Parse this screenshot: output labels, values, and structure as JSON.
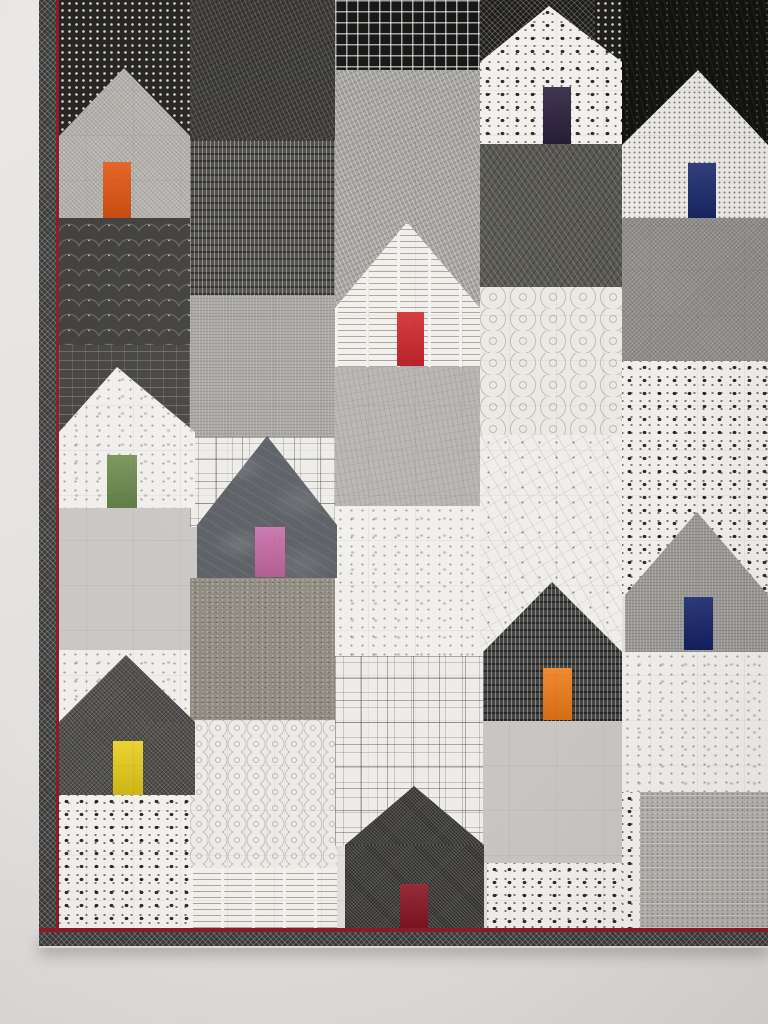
{
  "scene": {
    "description": "Wall-hung modern patchwork quilt of black, white and gray printed-fabric houses, each with a single brightly colored door; dark binding with thin red piping, photographed against a pale gray wall",
    "wall_color": "#e5e3e1",
    "house_count": 10,
    "door_colors": [
      "orange",
      "dark-plum",
      "navy",
      "red",
      "green",
      "pink",
      "blue",
      "tangerine",
      "yellow",
      "maroon"
    ],
    "quilt": {
      "binding_color": "#3a3938",
      "piping_color": "#8c1b2a"
    },
    "blocks": [
      {
        "name": "sky-dots-top-left",
        "fabric": "dots-light",
        "base": "#262523",
        "x": 59,
        "y": 0,
        "w": 131,
        "h": 136
      },
      {
        "name": "clamshell-black",
        "fabric": "clamshell",
        "base": "#403f3d",
        "x": 59,
        "y": 218,
        "w": 131,
        "h": 127
      },
      {
        "name": "shingle-sky",
        "fabric": "shingle",
        "base": "#454442",
        "x": 59,
        "y": 345,
        "w": 131,
        "h": 88
      },
      {
        "name": "light-gray-left",
        "fabric": "plain",
        "base": "#c9c7c3",
        "x": 59,
        "y": 508,
        "w": 141,
        "h": 142
      },
      {
        "name": "white-sky-left",
        "fabric": "splatter",
        "base": "#f0eeea",
        "x": 59,
        "y": 650,
        "w": 131,
        "h": 75
      },
      {
        "name": "square-dot-bottom-left",
        "fabric": "square-dot",
        "base": "#f2f0ec",
        "x": 59,
        "y": 795,
        "w": 131,
        "h": 133
      },
      {
        "name": "dark-basket-weave",
        "fabric": "weave",
        "base": "#3b3a38",
        "x": 190,
        "y": 0,
        "w": 145,
        "h": 140
      },
      {
        "name": "tally-dash-dark",
        "fabric": "vdash",
        "base": "#504f4c",
        "x": 190,
        "y": 140,
        "w": 145,
        "h": 155
      },
      {
        "name": "gray-linen-mid",
        "fabric": "linen",
        "base": "#a8a6a2",
        "x": 190,
        "y": 295,
        "w": 145,
        "h": 142
      },
      {
        "name": "ghost-squares-sky",
        "fabric": "squares-outline",
        "base": "#eeece8",
        "x": 190,
        "y": 437,
        "w": 147,
        "h": 90
      },
      {
        "name": "taupe-tweed",
        "fabric": "tweed",
        "base": "#8f8a80",
        "x": 190,
        "y": 578,
        "w": 147,
        "h": 142
      },
      {
        "name": "ring-print",
        "fabric": "rings",
        "base": "#edebe7",
        "x": 190,
        "y": 720,
        "w": 147,
        "h": 148
      },
      {
        "name": "text-print-bottom",
        "fabric": "text",
        "base": "#f1efea",
        "x": 190,
        "y": 868,
        "w": 147,
        "h": 60
      },
      {
        "name": "black-windowpane-grid",
        "fabric": "grid-light",
        "base": "#161614",
        "x": 335,
        "y": 0,
        "w": 148,
        "h": 70
      },
      {
        "name": "gray-tweed-sky",
        "fabric": "weave-light",
        "base": "#a5a39e",
        "x": 335,
        "y": 70,
        "w": 148,
        "h": 240
      },
      {
        "name": "gray-sketch",
        "fabric": "sketch",
        "base": "#b8b6b2",
        "x": 335,
        "y": 367,
        "w": 148,
        "h": 139
      },
      {
        "name": "white-splatter-mid",
        "fabric": "splatter",
        "base": "#f1efeb",
        "x": 335,
        "y": 506,
        "w": 148,
        "h": 150
      },
      {
        "name": "ghost-squares-bottom",
        "fabric": "squares-outline",
        "base": "#eeece8",
        "x": 335,
        "y": 656,
        "w": 148,
        "h": 190
      },
      {
        "name": "black-net-sky",
        "fabric": "net",
        "base": "#1c1b1a",
        "x": 480,
        "y": 0,
        "w": 115,
        "h": 62
      },
      {
        "name": "black-pebble-sky",
        "fabric": "dots-light",
        "base": "#201f1e",
        "x": 595,
        "y": 0,
        "w": 27,
        "h": 70
      },
      {
        "name": "dark-stitch-block",
        "fabric": "darkstitch",
        "base": "#56554f",
        "x": 480,
        "y": 144,
        "w": 147,
        "h": 143
      },
      {
        "name": "swirl-print",
        "fabric": "swirl",
        "base": "#ebe9e4",
        "x": 480,
        "y": 287,
        "w": 147,
        "h": 148
      },
      {
        "name": "constellation-print",
        "fabric": "constellation",
        "base": "#f0eeea",
        "x": 480,
        "y": 435,
        "w": 142,
        "h": 220
      },
      {
        "name": "light-gray-bottom",
        "fabric": "plain",
        "base": "#c8c6c3",
        "x": 483,
        "y": 721,
        "w": 144,
        "h": 142
      },
      {
        "name": "square-dot-bottom-mid",
        "fabric": "square-dot",
        "base": "#f2f0ec",
        "x": 487,
        "y": 863,
        "w": 140,
        "h": 65
      },
      {
        "name": "black-grass",
        "fabric": "grass",
        "base": "#121210",
        "x": 622,
        "y": 0,
        "w": 146,
        "h": 148
      },
      {
        "name": "gray-crosshatch-right",
        "fabric": "crosshatch-light",
        "base": "#8f8d89",
        "x": 622,
        "y": 218,
        "w": 146,
        "h": 143
      },
      {
        "name": "square-ring-sky",
        "fabric": "square-dot",
        "base": "#f0eeea",
        "x": 622,
        "y": 361,
        "w": 146,
        "h": 235
      },
      {
        "name": "white-splatter-right",
        "fabric": "splatter",
        "base": "#f0eeea",
        "x": 622,
        "y": 652,
        "w": 146,
        "h": 140
      },
      {
        "name": "gray-lace",
        "fabric": "lace",
        "base": "#b5b2ae",
        "x": 640,
        "y": 792,
        "w": 128,
        "h": 136
      },
      {
        "name": "square-dot-sliver",
        "fabric": "square-dot",
        "base": "#f2f0ec",
        "x": 622,
        "y": 792,
        "w": 18,
        "h": 136
      }
    ],
    "houses": [
      {
        "name": "house-orange-door",
        "fabric": "crosshatch-light",
        "base": "#b4b2ad",
        "roof": {
          "x": 59,
          "w": 131,
          "apex": 124,
          "apex_y": 68,
          "base_y": 136
        },
        "body": {
          "x": 59,
          "y": 136,
          "w": 131,
          "h": 82
        },
        "door": {
          "x": 103,
          "y": 162,
          "w": 28,
          "h": 56,
          "color": "#e2520f",
          "color_name": "orange"
        }
      },
      {
        "name": "house-plum-door",
        "fabric": "square-dot",
        "base": "#f2f0ec",
        "roof": {
          "x": 480,
          "w": 142,
          "apex": 549,
          "apex_y": 6,
          "base_y": 62
        },
        "body": {
          "x": 480,
          "y": 62,
          "w": 142,
          "h": 82
        },
        "door": {
          "x": 543,
          "y": 87,
          "w": 28,
          "h": 57,
          "color": "#2a1f3d",
          "color_name": "dark-plum"
        }
      },
      {
        "name": "house-navy-door",
        "fabric": "pindot",
        "base": "#ebe9e5",
        "roof": {
          "x": 622,
          "w": 146,
          "apex": 698,
          "apex_y": 70,
          "base_y": 145
        },
        "body": {
          "x": 622,
          "y": 145,
          "w": 146,
          "h": 73
        },
        "door": {
          "x": 688,
          "y": 163,
          "w": 28,
          "h": 55,
          "color": "#1a2a6e",
          "color_name": "navy"
        }
      },
      {
        "name": "house-red-door",
        "fabric": "text",
        "base": "#f1efea",
        "roof": {
          "x": 335,
          "w": 145,
          "apex": 407,
          "apex_y": 222,
          "base_y": 308
        },
        "body": {
          "x": 335,
          "y": 308,
          "w": 145,
          "h": 59
        },
        "door": {
          "x": 397,
          "y": 312,
          "w": 27,
          "h": 54,
          "color": "#cf2027",
          "color_name": "red"
        }
      },
      {
        "name": "house-green-door",
        "fabric": "splatter",
        "base": "#f1efeb",
        "roof": {
          "x": 59,
          "w": 136,
          "apex": 117,
          "apex_y": 367,
          "base_y": 432
        },
        "body": {
          "x": 59,
          "y": 432,
          "w": 136,
          "h": 76
        },
        "door": {
          "x": 107,
          "y": 455,
          "w": 30,
          "h": 53,
          "color": "#6b8a4a",
          "color_name": "green"
        }
      },
      {
        "name": "house-pink-door",
        "fabric": "batik",
        "base": "#5a5d62",
        "roof": {
          "x": 197,
          "w": 140,
          "apex": 267,
          "apex_y": 436,
          "base_y": 525
        },
        "body": {
          "x": 197,
          "y": 525,
          "w": 140,
          "h": 53
        },
        "door": {
          "x": 255,
          "y": 527,
          "w": 30,
          "h": 50,
          "color": "#c766a6",
          "color_name": "pink"
        }
      },
      {
        "name": "house-blue-door",
        "fabric": "linen",
        "base": "#9c9a96",
        "roof": {
          "x": 625,
          "w": 143,
          "apex": 697,
          "apex_y": 512,
          "base_y": 595
        },
        "body": {
          "x": 625,
          "y": 595,
          "w": 143,
          "h": 57
        },
        "door": {
          "x": 684,
          "y": 597,
          "w": 29,
          "h": 53,
          "color": "#16246b",
          "color_name": "blue"
        }
      },
      {
        "name": "house-tangerine-door",
        "fabric": "vdash",
        "base": "#454443",
        "roof": {
          "x": 483,
          "w": 139,
          "apex": 552,
          "apex_y": 582,
          "base_y": 652
        },
        "body": {
          "x": 483,
          "y": 652,
          "w": 139,
          "h": 69
        },
        "door": {
          "x": 543,
          "y": 668,
          "w": 29,
          "h": 52,
          "color": "#ef7d18",
          "color_name": "tangerine"
        }
      },
      {
        "name": "house-yellow-door",
        "fabric": "crosshatch-dark",
        "base": "#504f4d",
        "roof": {
          "x": 59,
          "w": 136,
          "apex": 126,
          "apex_y": 655,
          "base_y": 722
        },
        "body": {
          "x": 59,
          "y": 722,
          "w": 136,
          "h": 73
        },
        "door": {
          "x": 113,
          "y": 741,
          "w": 30,
          "h": 54,
          "color": "#e9ce1b",
          "color_name": "yellow"
        }
      },
      {
        "name": "house-maroon-door",
        "fabric": "finecross",
        "base": "#3e3d3b",
        "roof": {
          "x": 345,
          "w": 139,
          "apex": 414,
          "apex_y": 786,
          "base_y": 845
        },
        "body": {
          "x": 345,
          "y": 845,
          "w": 139,
          "h": 83
        },
        "door": {
          "x": 400,
          "y": 884,
          "w": 28,
          "h": 44,
          "color": "#8c1424",
          "color_name": "maroon"
        }
      }
    ]
  }
}
